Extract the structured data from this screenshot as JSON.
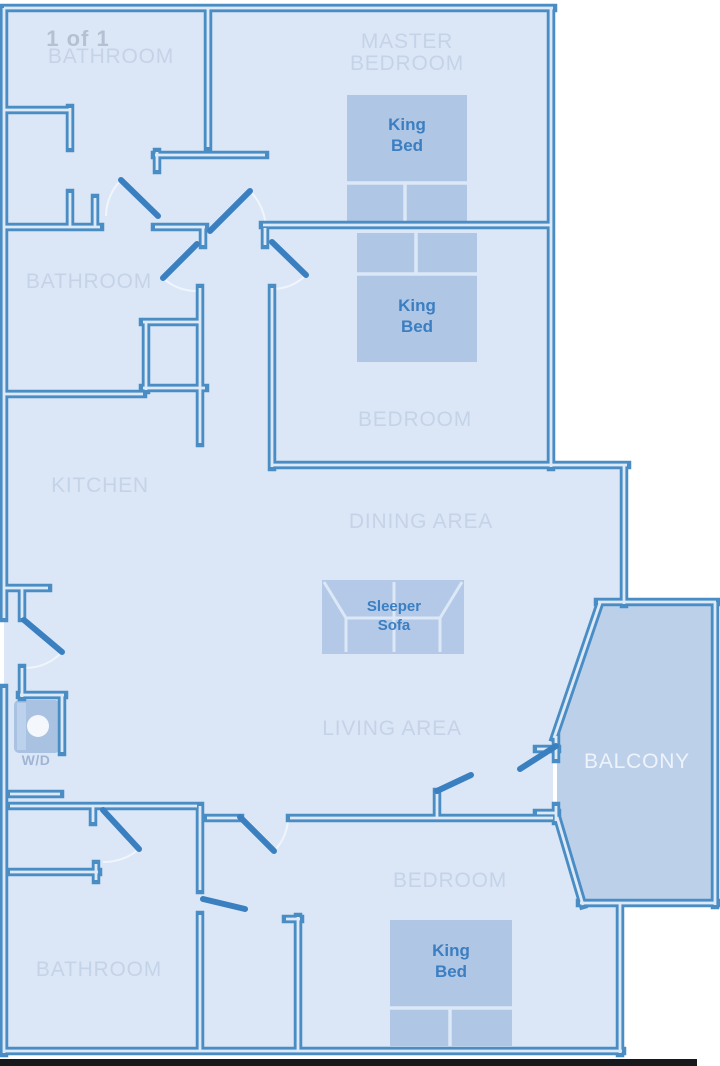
{
  "watermark": "1 of 1",
  "labels": {
    "bathroom_top": "BATHROOM",
    "master_line1": "MASTER",
    "master_line2": "BEDROOM",
    "bathroom_mid": "BATHROOM",
    "bedroom_mid": "BEDROOM",
    "kitchen": "KITCHEN",
    "dining": "DINING AREA",
    "living": "LIVING AREA",
    "balcony": "BALCONY",
    "bedroom_bottom": "BEDROOM",
    "bathroom_bottom": "BATHROOM"
  },
  "furniture": {
    "king_line1": "King",
    "king_line2": "Bed",
    "sofa_line1": "Sleeper",
    "sofa_line2": "Sofa",
    "washer_dryer": "W/D"
  },
  "colors": {
    "wall": "#4a8dc5",
    "wall_core": "#dde9f7",
    "floor_fill": "#dbe7f6",
    "balcony_fill": "#bcd0ea",
    "furniture_fill": "#afc6e4",
    "room_label": "#c5d3e9",
    "furniture_label": "#3b7ec1",
    "balcony_label": "#eef3fb",
    "watermark": "#b5c0d2",
    "bottom_bar": "#16181c"
  }
}
